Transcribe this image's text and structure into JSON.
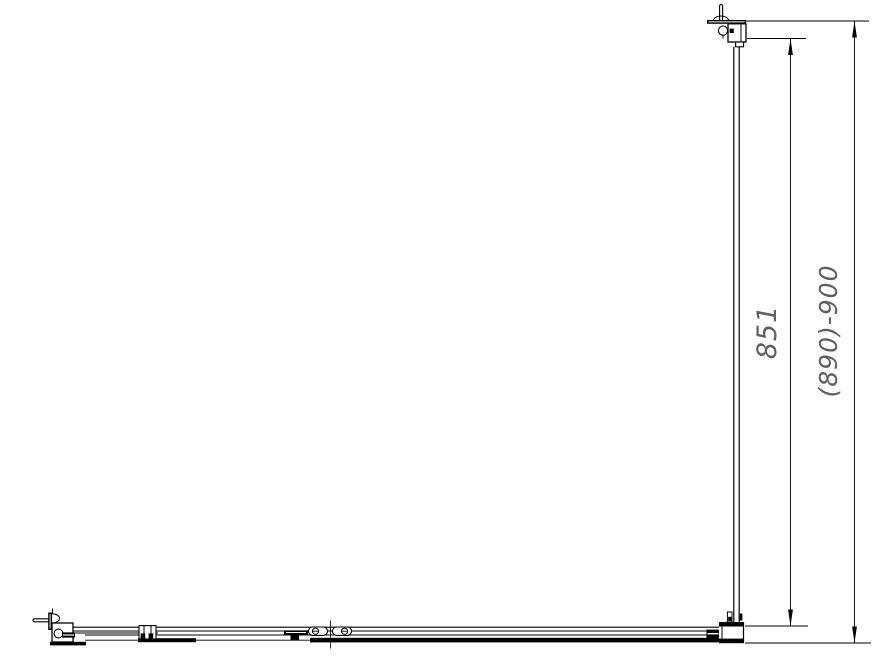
{
  "drawing": {
    "background_color": "#ffffff",
    "line_color": "#000000",
    "dimension_text_color": "#5f5f5f",
    "dimensions": {
      "glass_height": {
        "label": "851"
      },
      "overall_height": {
        "label": "(890)-900"
      }
    }
  }
}
